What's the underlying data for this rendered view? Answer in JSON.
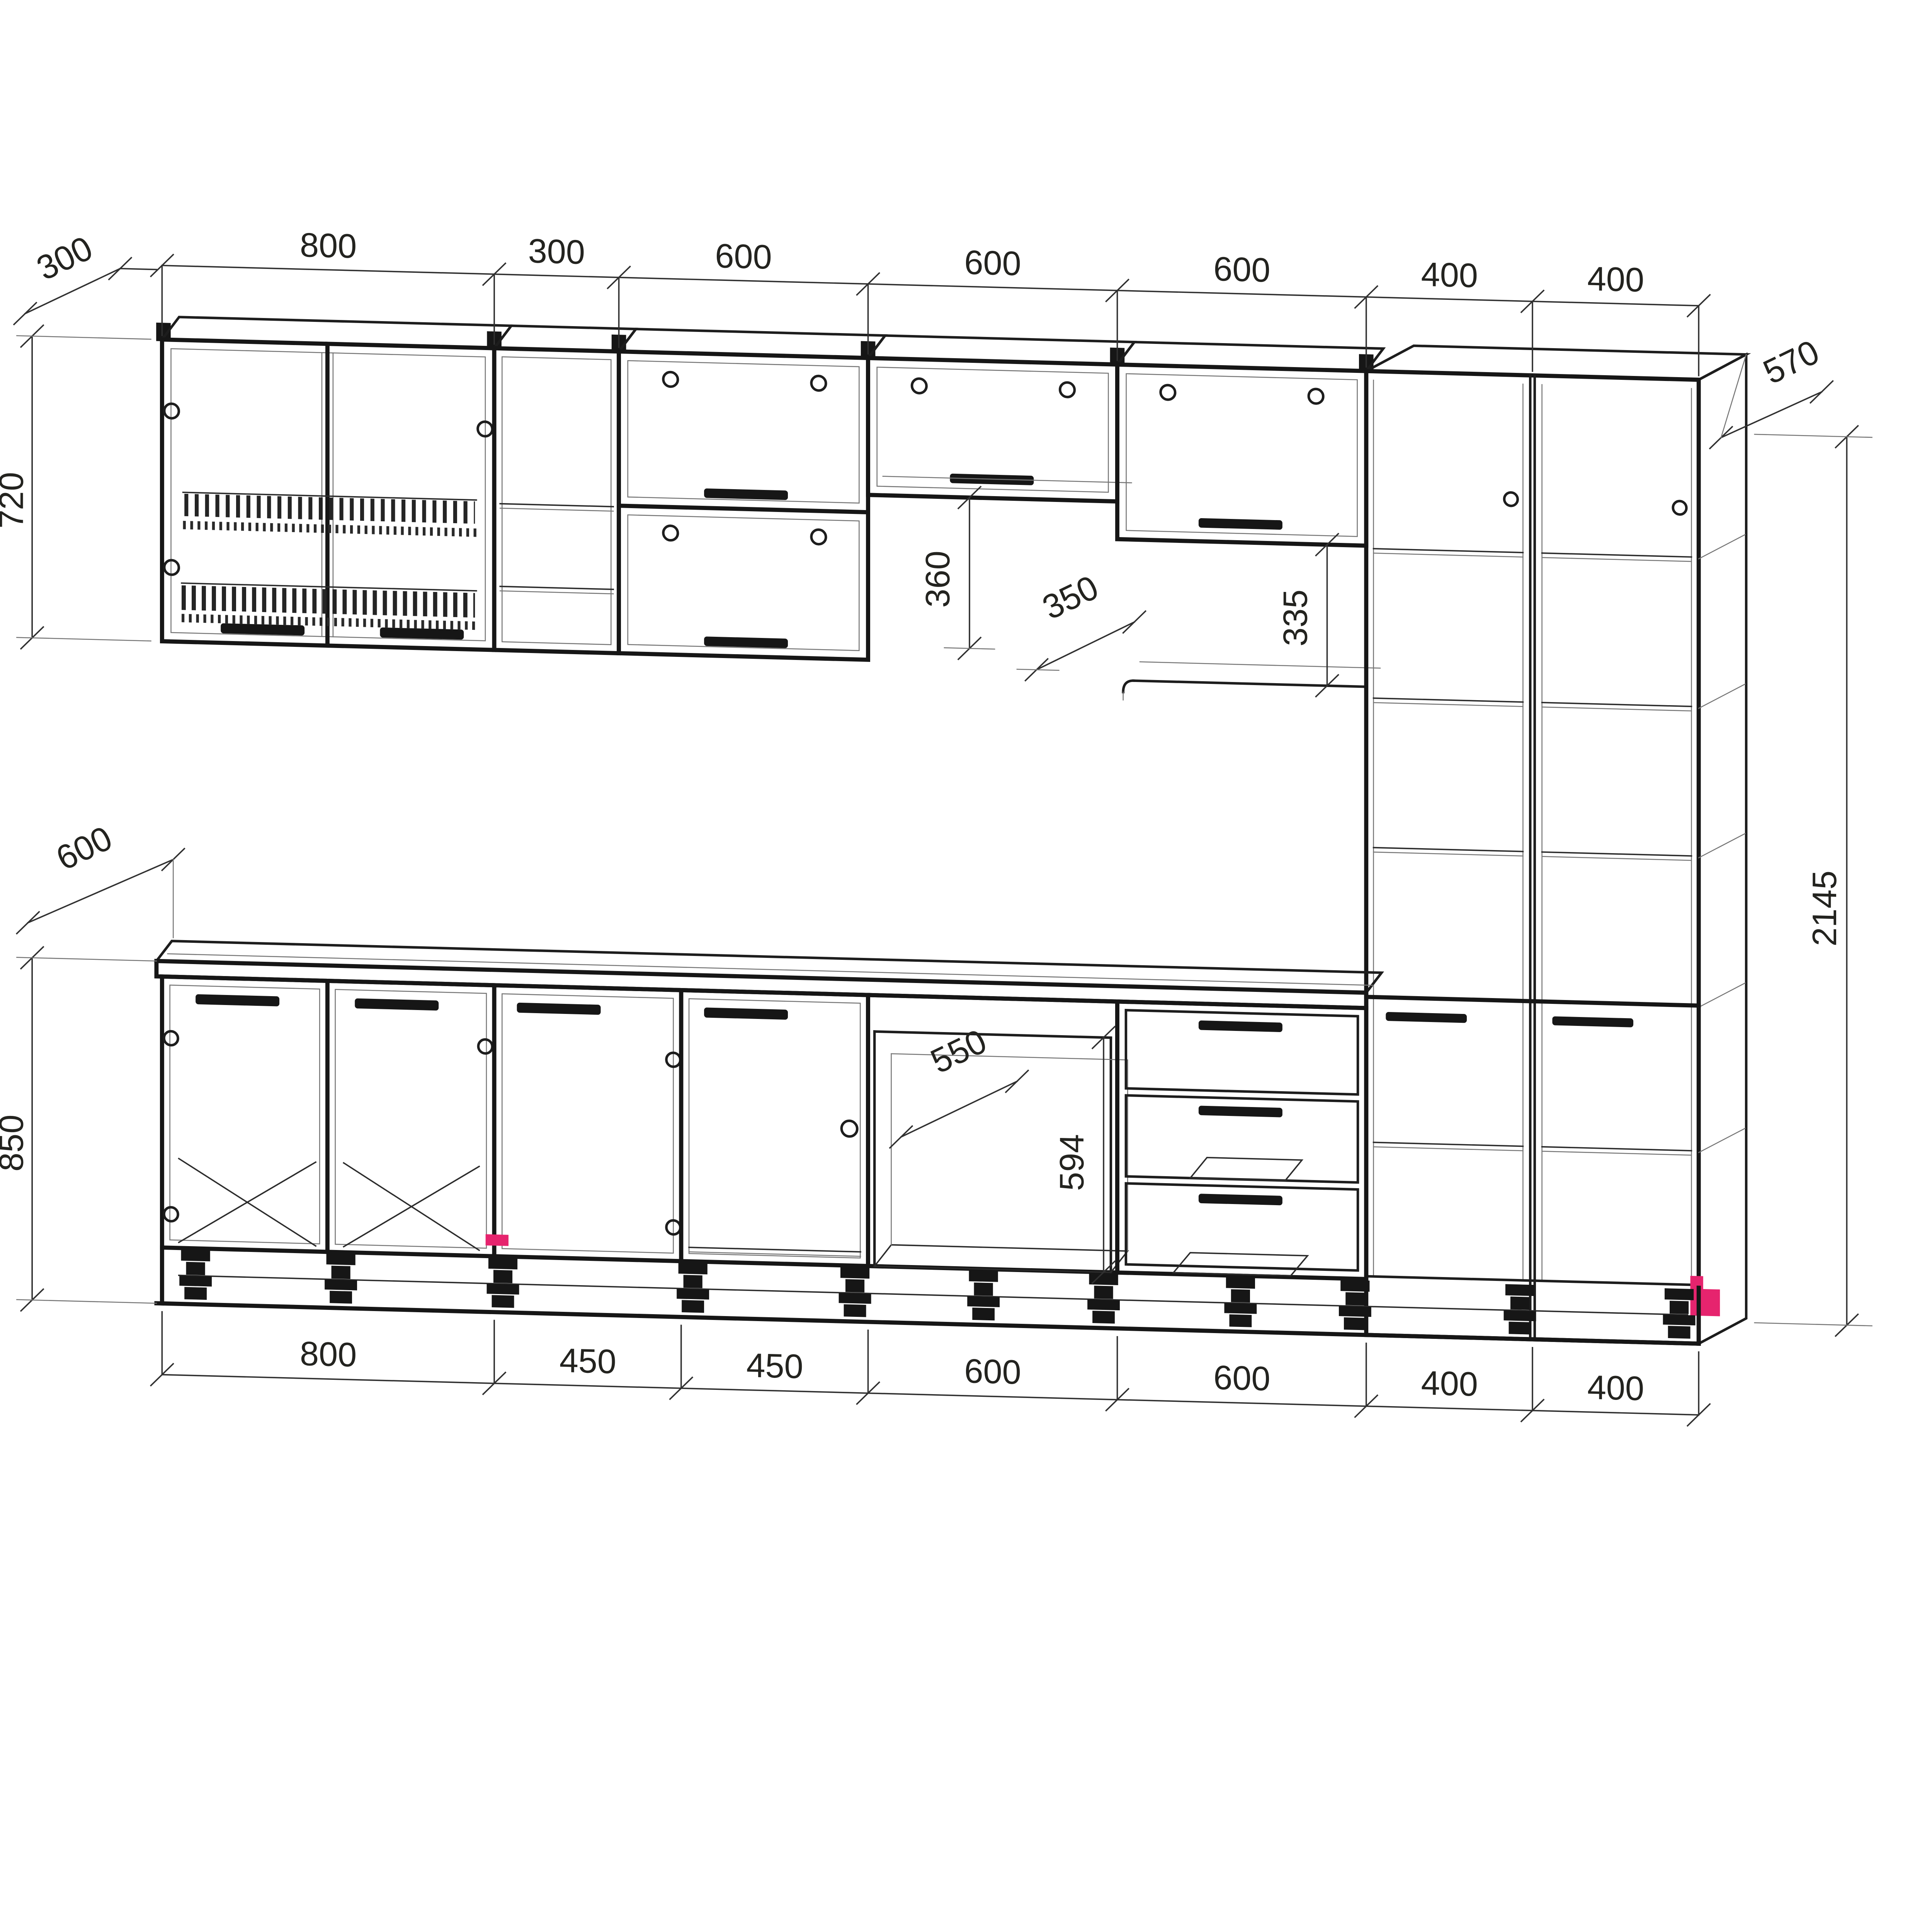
{
  "drawing": {
    "background": "#ffffff",
    "line_color": "#1d1d1d",
    "accent_color": "#e6246e"
  },
  "dims": {
    "top": [
      "800",
      "300",
      "600",
      "600",
      "600",
      "400",
      "400"
    ],
    "bottom": [
      "800",
      "450",
      "450",
      "600",
      "600",
      "400",
      "400"
    ],
    "left": {
      "wall_depth": "300",
      "wall_height": "720",
      "base_depth": "600",
      "base_height": "850"
    },
    "right": {
      "tall_depth": "570",
      "tall_height": "2145"
    },
    "inner": {
      "bridge_gap_height": "360",
      "bridge_shelf_depth": "350",
      "open_shelf_gap": "335",
      "niche_depth": "550",
      "niche_height": "594"
    }
  }
}
